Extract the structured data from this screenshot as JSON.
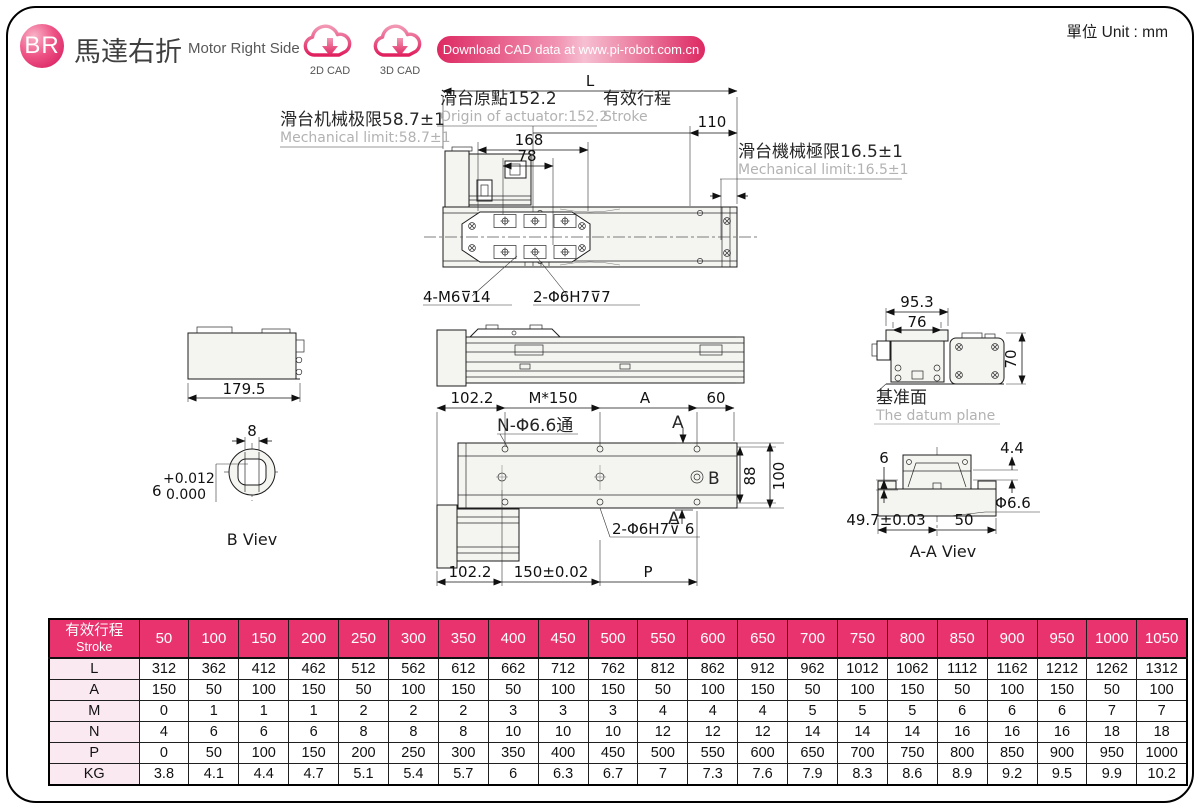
{
  "header": {
    "logo": "BR",
    "title_cn": "馬達右折",
    "title_en": "Motor Right Side",
    "cad_2d": "2D CAD",
    "cad_3d": "3D CAD",
    "download_banner": "Download CAD data at www.pi-robot.com.cn",
    "unit": "單位 Unit : mm"
  },
  "colors": {
    "accent": "#E8336E",
    "accent_dark": "#D4145A",
    "row_label_bg": "#FBE9F1",
    "secondary_text": "#B2B2B2"
  },
  "drawing": {
    "top_view": {
      "dim_L": "L",
      "origin_cn": "滑台原點152.2",
      "origin_en": "Origin of actuator:152.2",
      "stroke_cn": "有效行程",
      "stroke_en": "Stroke",
      "dim_110": "110",
      "limit_left_cn": "滑台机械极限58.7±1",
      "limit_left_en": "Mechanical limit:58.7±1",
      "dim_168": "168",
      "dim_78": "78",
      "limit_right_cn": "滑台機械極限16.5±1",
      "limit_right_en": "Mechanical limit:16.5±1",
      "leader_m6": "4-M6⊽14",
      "leader_h7": "2-Φ6H7⊽7"
    },
    "side_view": {
      "dim_179_5": "179.5"
    },
    "b_view": {
      "dim_8": "8",
      "dim_6": "6",
      "tol_upper": "+0.012",
      "tol_lower": "0.000",
      "label": "B Viev"
    },
    "plan_view": {
      "dim_102_2": "102.2",
      "dim_pitch": "M*150",
      "dim_A": "A",
      "dim_60": "60",
      "leader_n": "N-Φ6.6通",
      "label_B": "B",
      "dim_88": "88",
      "dim_100": "100",
      "section_A_top": "A",
      "section_A_bottom": "A",
      "leader_h7": "2-Φ6H7⊽ 6",
      "dim_102_2b": "102.2",
      "dim_150": "150±0.02",
      "dim_P": "P"
    },
    "end_view": {
      "dim_95_3": "95.3",
      "dim_76": "76",
      "dim_70": "70",
      "datum_cn": "基准面",
      "datum_en": "The datum plane"
    },
    "aa_view": {
      "dim_6": "6",
      "dim_4_4": "4.4",
      "dim_phi": "Φ6.6",
      "dim_49_7": "49.7±0.03",
      "dim_50": "50",
      "label": "A-A Viev"
    }
  },
  "table": {
    "header_cn": "有效行程",
    "header_en": "Stroke",
    "columns": [
      50,
      100,
      150,
      200,
      250,
      300,
      350,
      400,
      450,
      500,
      550,
      600,
      650,
      700,
      750,
      800,
      850,
      900,
      950,
      1000,
      1050
    ],
    "rows": [
      {
        "label": "L",
        "values": [
          312,
          362,
          412,
          462,
          512,
          562,
          612,
          662,
          712,
          762,
          812,
          862,
          912,
          962,
          1012,
          1062,
          1112,
          1162,
          1212,
          1262,
          1312
        ]
      },
      {
        "label": "A",
        "values": [
          150,
          50,
          100,
          150,
          50,
          100,
          150,
          50,
          100,
          150,
          50,
          100,
          150,
          50,
          100,
          150,
          50,
          100,
          150,
          50,
          100
        ]
      },
      {
        "label": "M",
        "values": [
          0,
          1,
          1,
          1,
          2,
          2,
          2,
          3,
          3,
          3,
          4,
          4,
          4,
          5,
          5,
          5,
          6,
          6,
          6,
          7,
          7
        ]
      },
      {
        "label": "N",
        "values": [
          4,
          6,
          6,
          6,
          8,
          8,
          8,
          10,
          10,
          10,
          12,
          12,
          12,
          14,
          14,
          14,
          16,
          16,
          16,
          18,
          18
        ]
      },
      {
        "label": "P",
        "values": [
          0,
          50,
          100,
          150,
          200,
          250,
          300,
          350,
          400,
          450,
          500,
          550,
          600,
          650,
          700,
          750,
          800,
          850,
          900,
          950,
          1000
        ]
      },
      {
        "label": "KG",
        "values": [
          3.8,
          4.1,
          4.4,
          4.7,
          5.1,
          5.4,
          5.7,
          6,
          6.3,
          6.7,
          7,
          7.3,
          7.6,
          7.9,
          8.3,
          8.6,
          8.9,
          9.2,
          9.5,
          9.9,
          10.2
        ]
      }
    ]
  }
}
